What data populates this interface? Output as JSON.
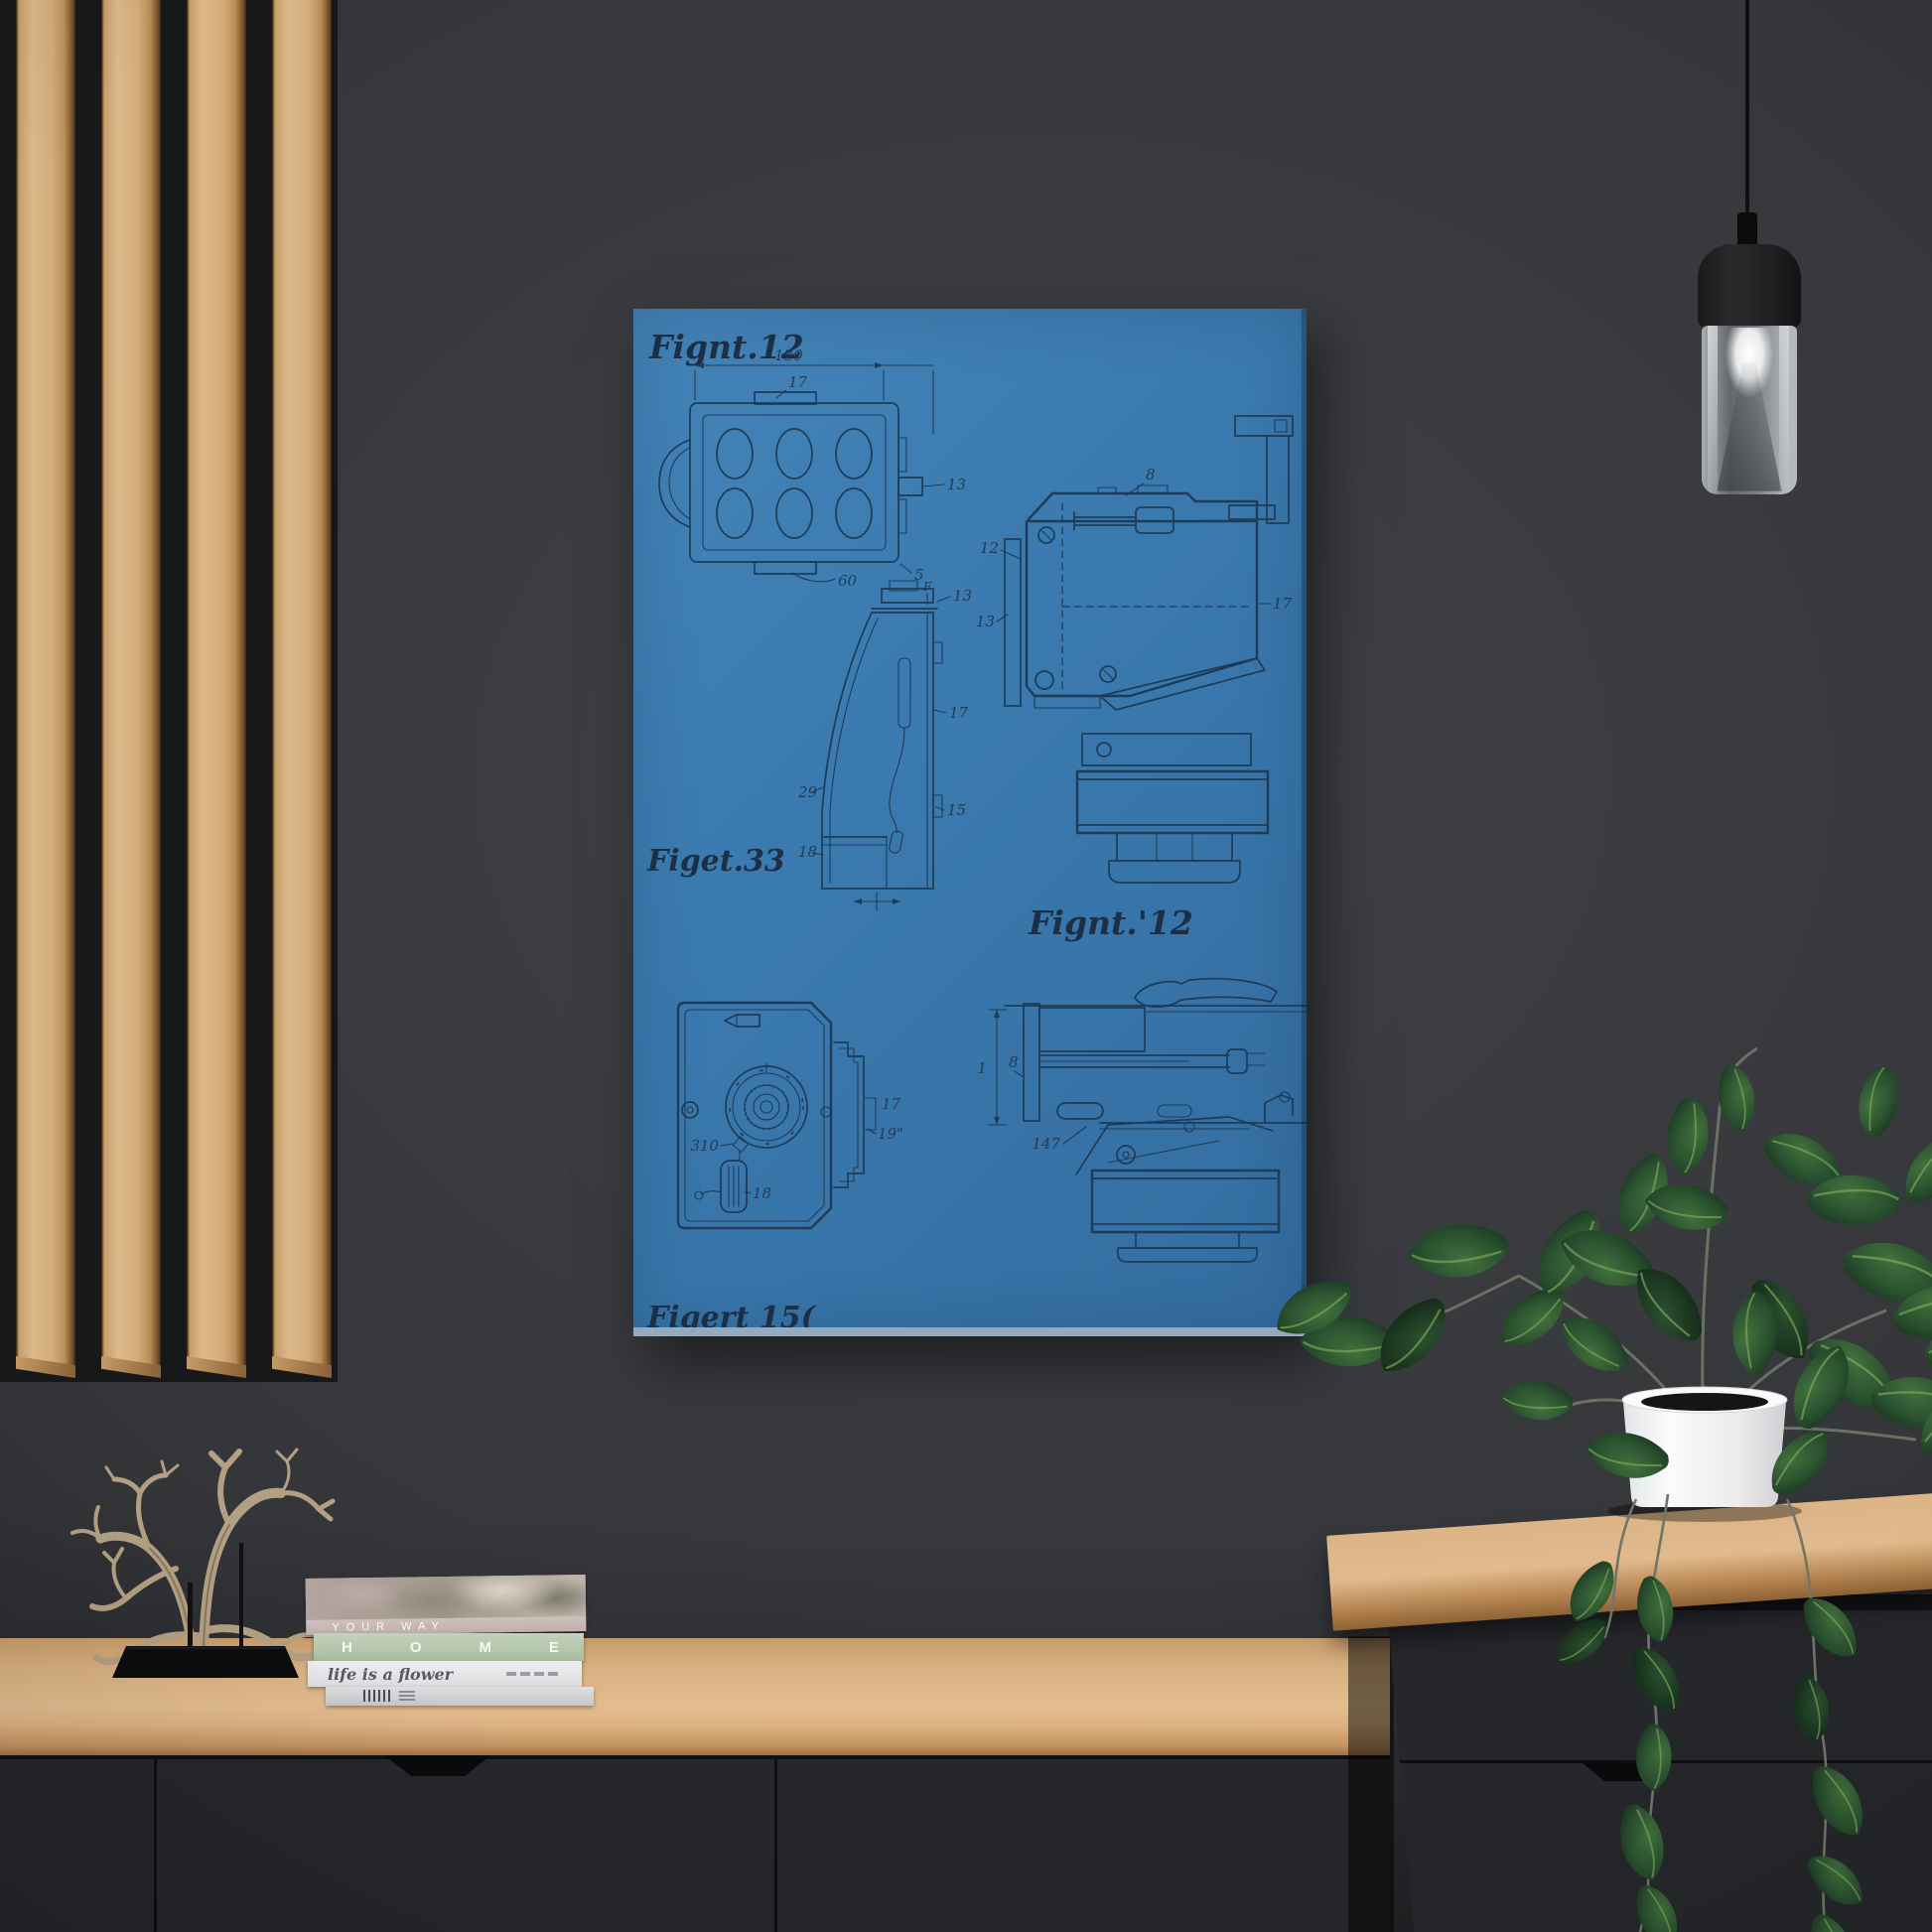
{
  "scene": {
    "description": "Blueprint camera patent poster on a dark charcoal wall, wood slat panel at left, pendant lamp and trailing potted plant at right, wooden sideboard with books and driftwood sculpture below"
  },
  "poster": {
    "figure_labels": {
      "top_left": "Fignt.12",
      "middle_left": "Figet.33",
      "center": "Fignt.'12",
      "bottom_left": "Figert 15("
    },
    "annotations": {
      "a_width": "130",
      "a_tab": "17",
      "a_right": "13",
      "a_bottom": "60",
      "a_corner": "5",
      "b_f": "F",
      "b_top": "13",
      "b_mid": "17",
      "b_low": "15",
      "b_left": "29",
      "b_base": "18",
      "c_top": "8",
      "c_left_upper": "12",
      "c_left_lower": "13",
      "c_right": "17",
      "d_latch": "310",
      "d_capsule": "18",
      "d_bracket_upper": "17",
      "d_bracket_lower": "19\"",
      "e_dim": "1",
      "e_shaft": "8",
      "e_lever": "147"
    },
    "colors": {
      "canvas": "#3a79ae",
      "ink": "#1e3c58",
      "edge_highlight": "#9db0bf"
    }
  },
  "books": {
    "top": "YOUR WAY",
    "second": "HOME",
    "third": "life is a flower"
  },
  "palette": {
    "wall": "#36383c",
    "slat_wood": "#d2a873",
    "sideboard_wood": "#dcb285",
    "cabinet_dark": "#26272b",
    "leaf_green": "#2c5231",
    "pot_white": "#f1f1f2",
    "lamp_black": "#1a1a1c",
    "driftwood": "#b3a083"
  }
}
